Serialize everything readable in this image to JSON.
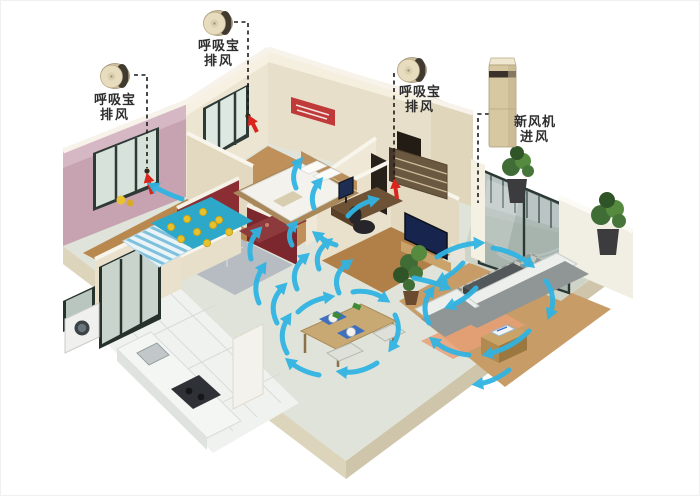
{
  "diagram": {
    "type": "apartment-ventilation-floorplan",
    "background": "#ffffff"
  },
  "devices": {
    "exhaust_units": [
      {
        "name": "breather-exhaust-1",
        "label_line1": "呼吸宝",
        "label_line2": "排风"
      },
      {
        "name": "breather-exhaust-2",
        "label_line1": "呼吸宝",
        "label_line2": "排风"
      },
      {
        "name": "breather-exhaust-3",
        "label_line1": "呼吸宝",
        "label_line2": "排风"
      }
    ],
    "fresh_air_unit": {
      "name": "fresh-air-machine",
      "label_line1": "新风机",
      "label_line2": "进风"
    }
  },
  "colors": {
    "airflow_arrow": "#31b4e2",
    "exhaust_arrow": "#da251d",
    "leader_line": "#1c1c1c",
    "wall_cream": "#ece5d1",
    "wall_pink": "#c7a3b2",
    "wall_red": "#8a2e34",
    "floor_wood": "#bf9059",
    "floor_tile": "#dfe3d9"
  }
}
